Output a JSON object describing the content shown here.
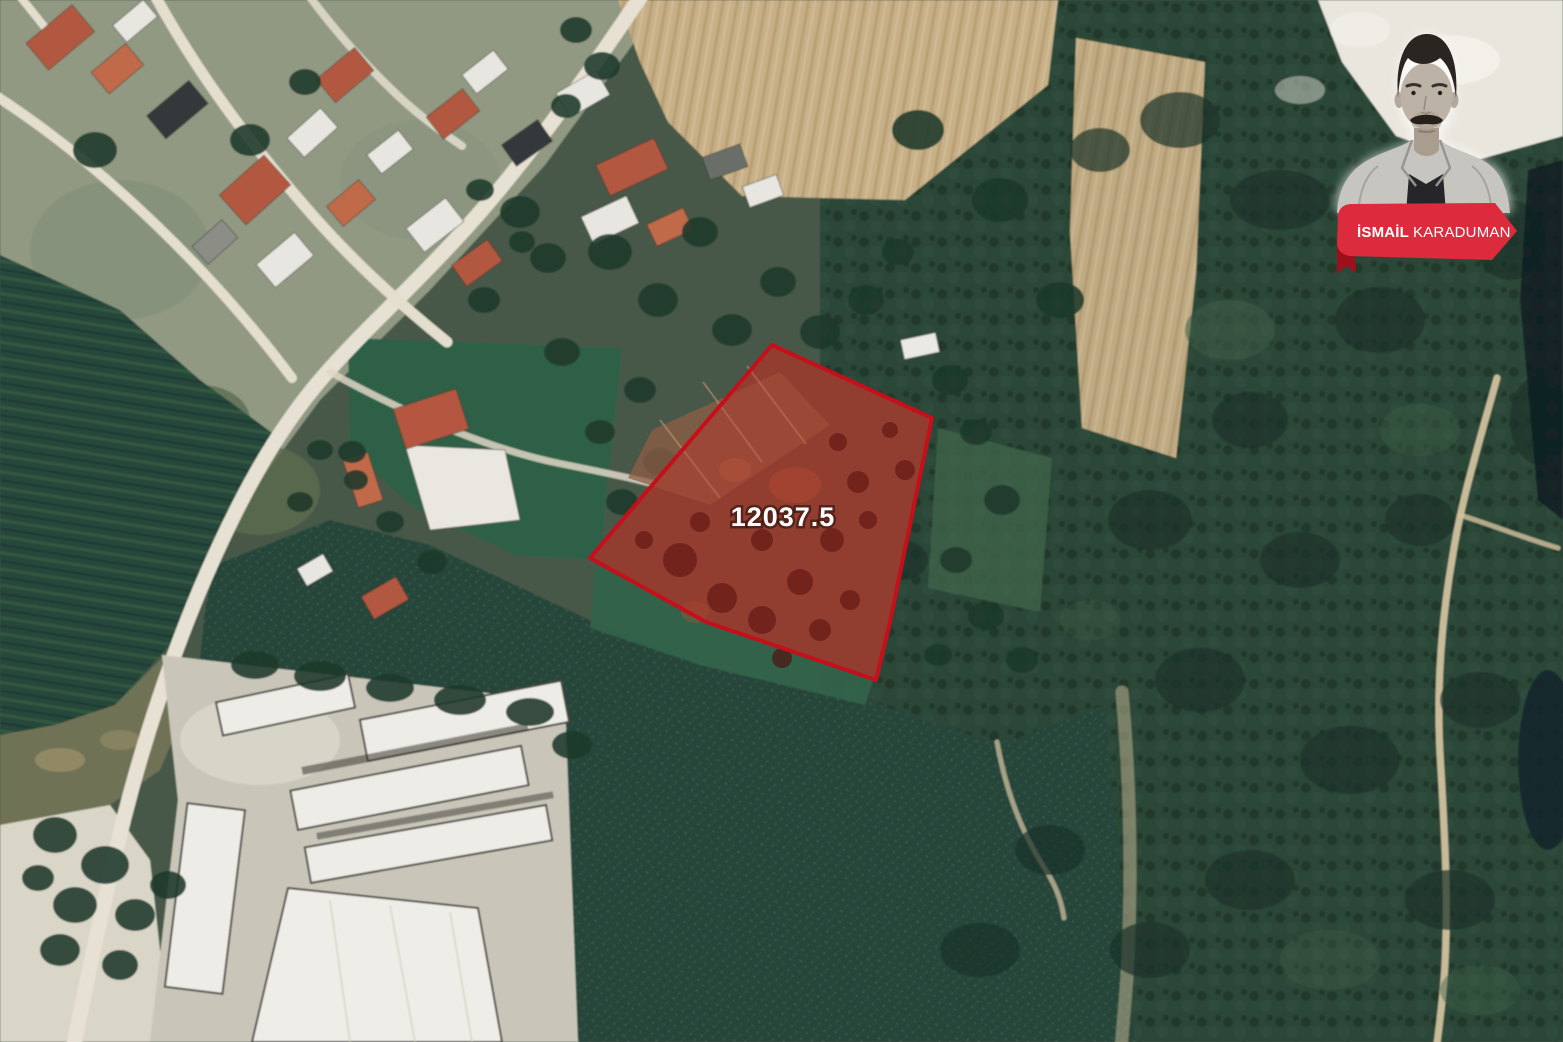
{
  "byline": {
    "first_name": "İSMAİL",
    "last_name": "KARADUMAN"
  },
  "map": {
    "parcel": {
      "area_label": "12037.5"
    }
  },
  "colors": {
    "ribbon_red": "#DB2B3C",
    "ribbon_fold": "#9C101D",
    "parcel_border": "#C50F1B",
    "parcel_fill_tint": "#C81E1E"
  }
}
